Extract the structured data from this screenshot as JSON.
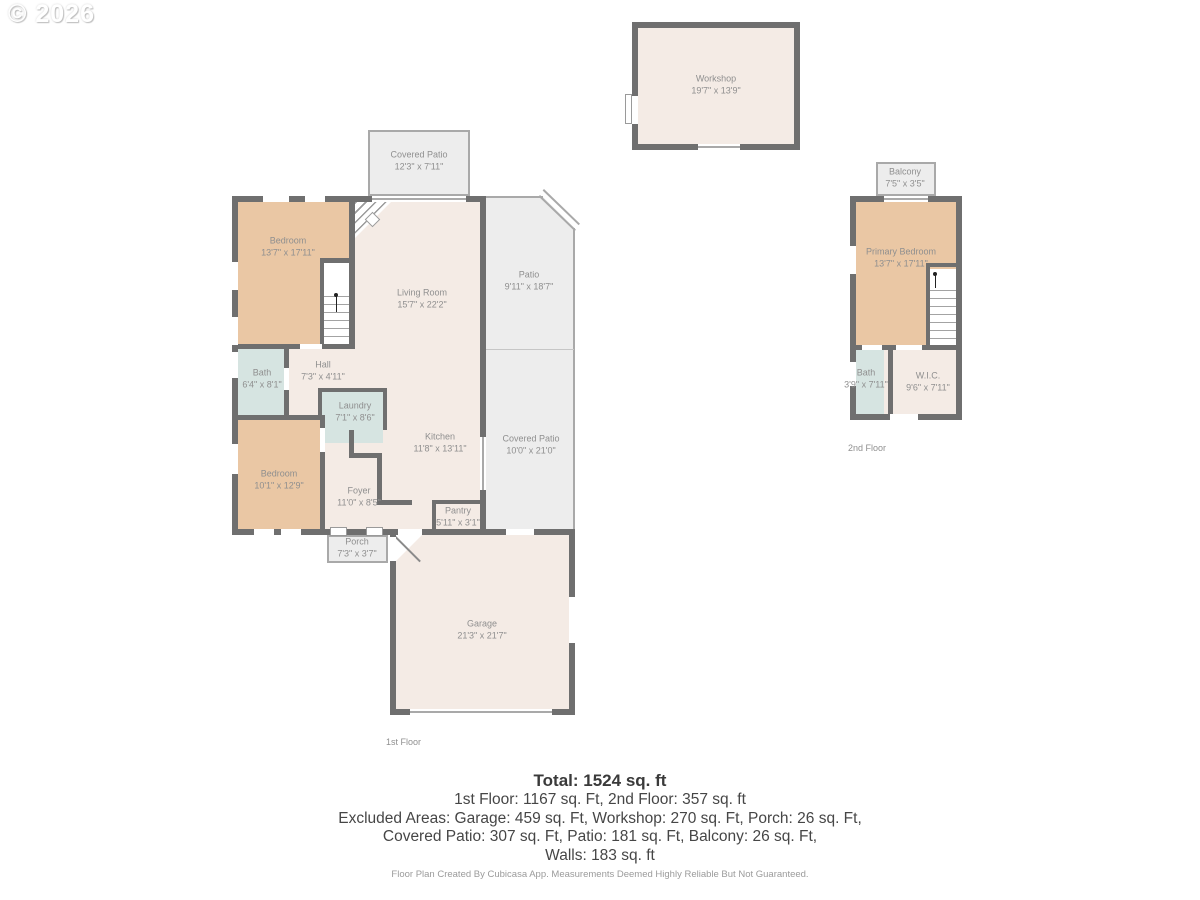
{
  "watermark": "© 2026",
  "colors": {
    "wall": "#6f6f6f",
    "cream": "#f4ebe5",
    "tan": "#eac7a4",
    "blue": "#d6e4e1",
    "outdoor": "#ededed",
    "outline": "#a9a9a9",
    "label_text": "#8f8f8f"
  },
  "first_floor": {
    "floor_label": "1st Floor",
    "covered_patio_top": {
      "name": "Covered Patio",
      "dims": "12'3\" x 7'11\""
    },
    "bedroom_upper": {
      "name": "Bedroom",
      "dims": "13'7\" x 17'11\""
    },
    "living_room": {
      "name": "Living Room",
      "dims": "15'7\" x 22'2\""
    },
    "patio": {
      "name": "Patio",
      "dims": "9'11\" x 18'7\""
    },
    "bath": {
      "name": "Bath",
      "dims": "6'4\" x 8'1\""
    },
    "hall": {
      "name": "Hall",
      "dims": "7'3\" x 4'11\""
    },
    "laundry": {
      "name": "Laundry",
      "dims": "7'1\" x 8'6\""
    },
    "kitchen": {
      "name": "Kitchen",
      "dims": "11'8\" x 13'11\""
    },
    "covered_patio_right": {
      "name": "Covered Patio",
      "dims": "10'0\" x 21'0\""
    },
    "bedroom_lower": {
      "name": "Bedroom",
      "dims": "10'1\" x 12'9\""
    },
    "foyer": {
      "name": "Foyer",
      "dims": "11'0\" x 8'5\""
    },
    "pantry": {
      "name": "Pantry",
      "dims": "5'11\" x 3'1\""
    },
    "porch": {
      "name": "Porch",
      "dims": "7'3\" x 3'7\""
    },
    "garage": {
      "name": "Garage",
      "dims": "21'3\" x 21'7\""
    }
  },
  "workshop": {
    "name": "Workshop",
    "dims": "19'7\" x 13'9\""
  },
  "second_floor": {
    "floor_label": "2nd Floor",
    "balcony": {
      "name": "Balcony",
      "dims": "7'5\" x 3'5\""
    },
    "primary_bedroom": {
      "name": "Primary Bedroom",
      "dims": "13'7\" x 17'11\""
    },
    "bath": {
      "name": "Bath",
      "dims": "3'9\" x 7'11\""
    },
    "wic": {
      "name": "W.I.C.",
      "dims": "9'6\" x 7'11\""
    }
  },
  "summary": {
    "total": "Total: 1524 sq. ft",
    "line1": "1st Floor: 1167 sq. Ft, 2nd Floor: 357 sq. ft",
    "line2": "Excluded Areas: Garage: 459 sq. Ft, Workshop: 270 sq. Ft, Porch: 26 sq. Ft,",
    "line3": "Covered Patio: 307 sq. Ft, Patio: 181 sq. Ft, Balcony: 26 sq. Ft,",
    "line4": "Walls: 183 sq. ft"
  },
  "footer": "Floor Plan Created By Cubicasa App. Measurements Deemed Highly Reliable But Not Guaranteed."
}
